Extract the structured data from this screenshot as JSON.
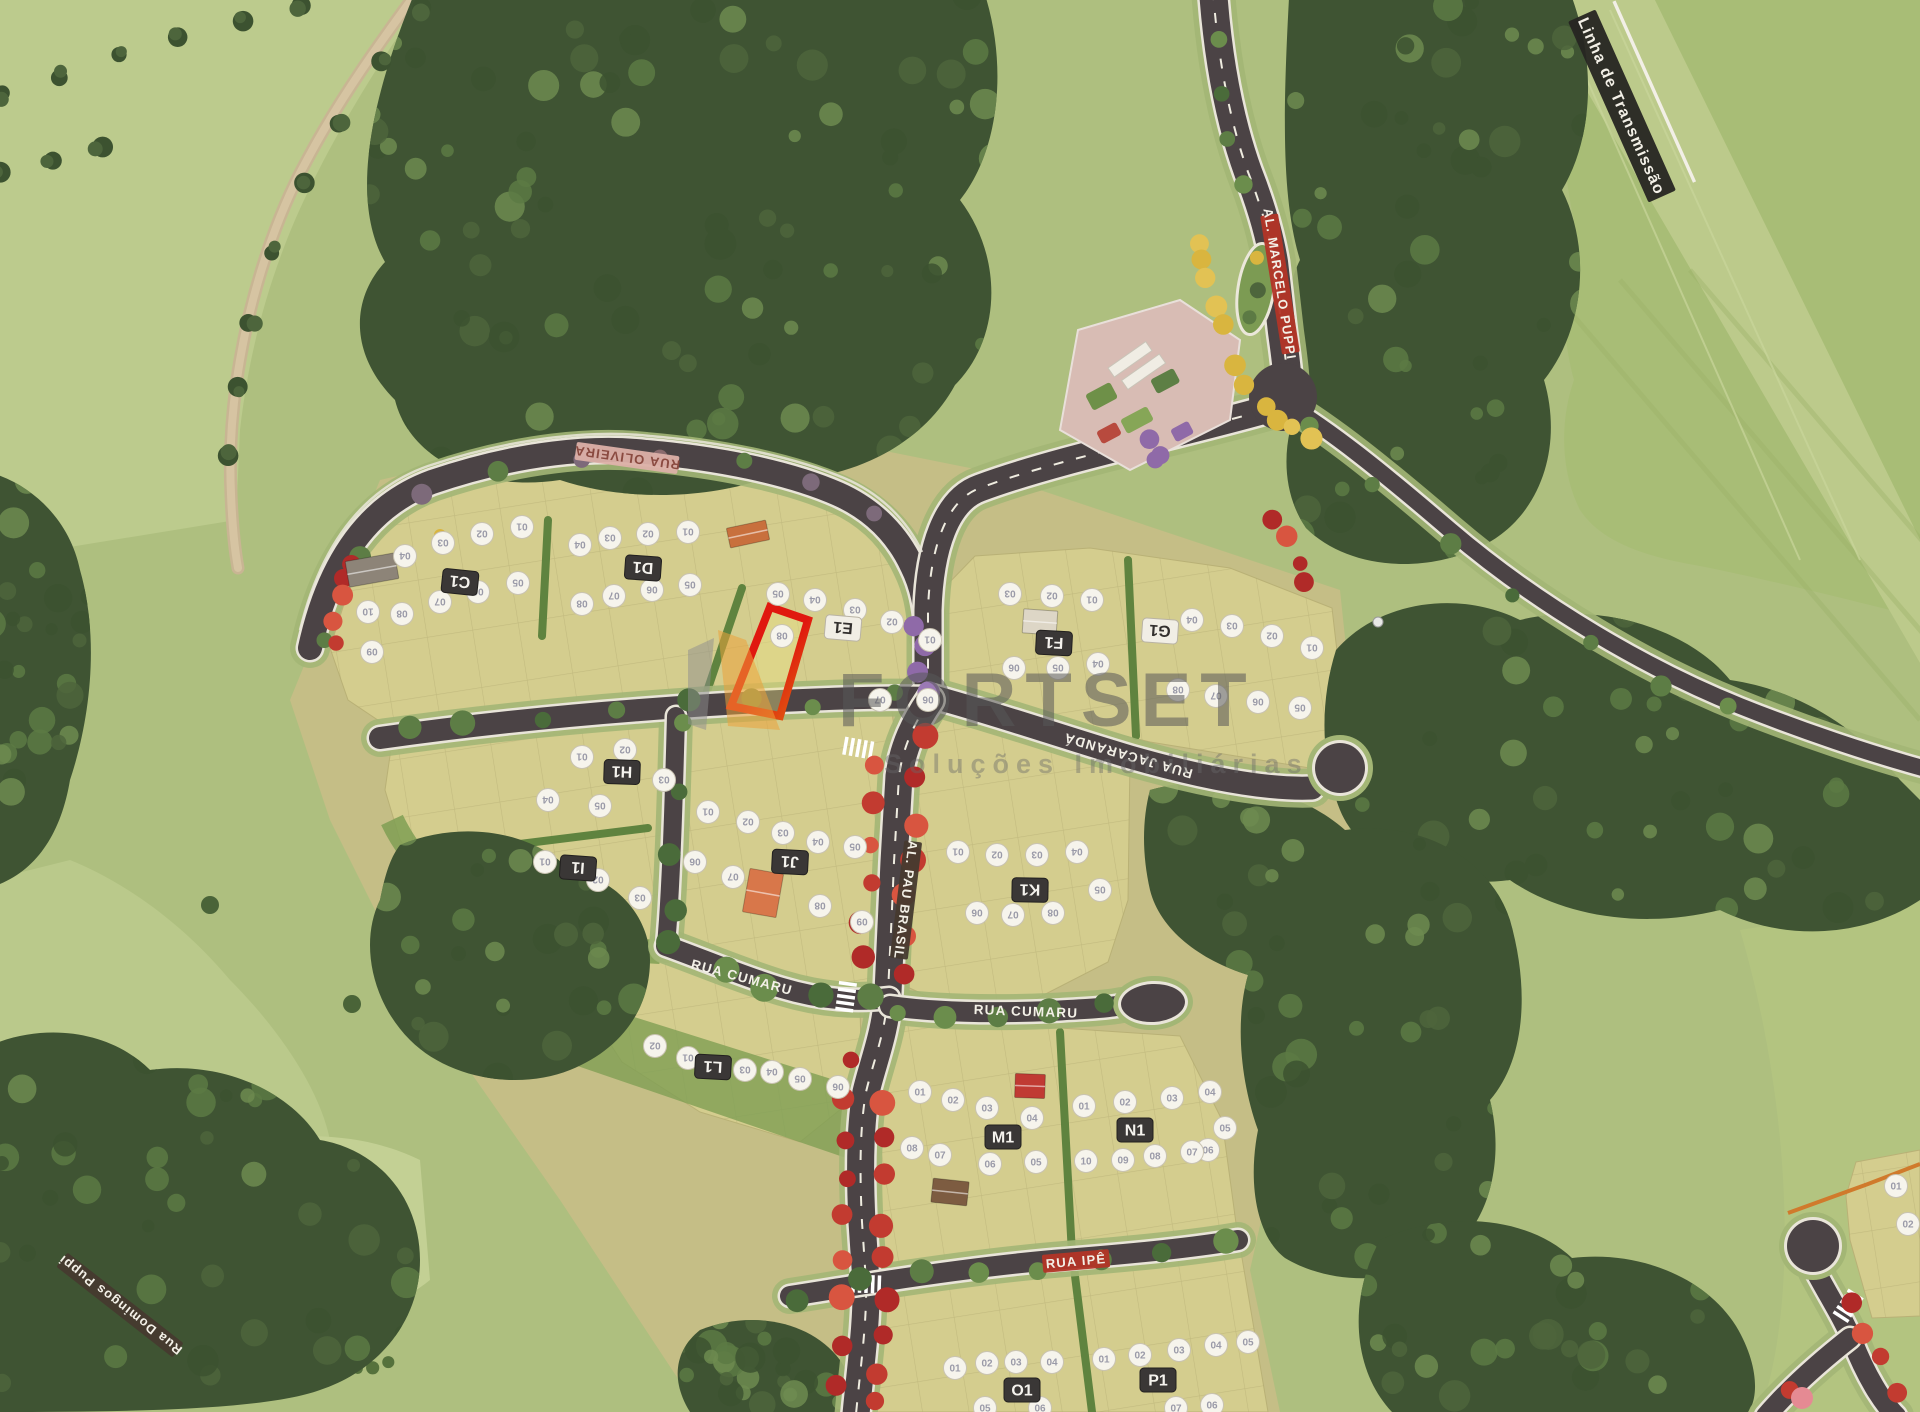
{
  "watermark": {
    "brand": "FORTSET",
    "tagline": "Soluções Imobiliárias"
  },
  "colors": {
    "highlight_outline": "#e0180f",
    "highlight_secondary": "#e06a10",
    "asphalt": "#4b4345",
    "lot_fill": "#d4cd8e",
    "forest": "#3f5433",
    "meadow": "#aebf7f",
    "badge_dark": "#3a3736",
    "badge_light": "#f1eee5",
    "marker_fill": "#f6f4ec",
    "flower_red": "#c23b30",
    "flower_yellow": "#d9b53f",
    "flower_purple": "#8f6aa8",
    "watermark_logo_orange": "#eba33b",
    "watermark_logo_gray": "#8e8e8e"
  },
  "streets": [
    {
      "name": "RUA OLIVEIRA",
      "x": 627,
      "y": 458,
      "rot": 188,
      "style": "pink"
    },
    {
      "name": "RUA JACARANDÁ",
      "x": 1128,
      "y": 756,
      "rot": 196,
      "style": "road"
    },
    {
      "name": "AL. PAU BRASIL",
      "x": 906,
      "y": 900,
      "rot": 97,
      "style": "darkstrip"
    },
    {
      "name": "RUA CUMARU",
      "x": 742,
      "y": 977,
      "rot": 15,
      "style": "road"
    },
    {
      "name": "RUA CUMARU",
      "x": 1026,
      "y": 1011,
      "rot": 2,
      "style": "road"
    },
    {
      "name": "RUA IPÊ",
      "x": 1076,
      "y": 1261,
      "rot": -5,
      "style": "redsign"
    },
    {
      "name": "AL. MARCELO PUPPI",
      "x": 1280,
      "y": 284,
      "rot": 81,
      "style": "redsign"
    },
    {
      "name": "Rua Domingos Puppi",
      "x": 120,
      "y": 1305,
      "rot": 218,
      "style": "darkstrip"
    },
    {
      "name": "Linha de Transmissão",
      "x": 1622,
      "y": 106,
      "rot": 66,
      "style": "blacksign"
    }
  ],
  "blocks": [
    {
      "id": "C1",
      "flipped": true,
      "badge": {
        "x": 460,
        "y": 582,
        "rot": 186,
        "style": "dark"
      },
      "lots": [
        [
          "01",
          522,
          527
        ],
        [
          "02",
          482,
          534
        ],
        [
          "03",
          443,
          543
        ],
        [
          "04",
          405,
          556
        ],
        [
          "05",
          518,
          583
        ],
        [
          "06",
          478,
          592
        ],
        [
          "07",
          440,
          602
        ],
        [
          "08",
          402,
          614
        ],
        [
          "09",
          372,
          652
        ],
        [
          "10",
          368,
          612
        ]
      ]
    },
    {
      "id": "D1",
      "flipped": true,
      "badge": {
        "x": 643,
        "y": 568,
        "rot": 184,
        "style": "dark"
      },
      "lots": [
        [
          "01",
          688,
          532
        ],
        [
          "02",
          648,
          534
        ],
        [
          "03",
          610,
          538
        ],
        [
          "04",
          580,
          545
        ],
        [
          "05",
          690,
          585
        ],
        [
          "06",
          652,
          590
        ],
        [
          "07",
          614,
          596
        ],
        [
          "08",
          582,
          604
        ]
      ]
    },
    {
      "id": "E1",
      "flipped": true,
      "badge": {
        "x": 843,
        "y": 628,
        "rot": 185,
        "style": "light"
      },
      "lots": [
        [
          "01",
          930,
          640
        ],
        [
          "02",
          892,
          622
        ],
        [
          "03",
          855,
          610
        ],
        [
          "04",
          815,
          600
        ],
        [
          "05",
          778,
          594
        ],
        [
          "06",
          928,
          700
        ],
        [
          "07",
          880,
          700
        ],
        [
          "08",
          782,
          636
        ]
      ]
    },
    {
      "id": "F1",
      "flipped": true,
      "badge": {
        "x": 1054,
        "y": 643,
        "rot": 183,
        "style": "dark"
      },
      "lots": [
        [
          "01",
          1092,
          600
        ],
        [
          "02",
          1052,
          596
        ],
        [
          "03",
          1010,
          594
        ],
        [
          "04",
          1098,
          664
        ],
        [
          "05",
          1058,
          668
        ],
        [
          "06",
          1014,
          668
        ]
      ]
    },
    {
      "id": "G1",
      "flipped": true,
      "badge": {
        "x": 1160,
        "y": 631,
        "rot": 184,
        "style": "light"
      },
      "lots": [
        [
          "01",
          1312,
          648
        ],
        [
          "02",
          1272,
          636
        ],
        [
          "03",
          1232,
          626
        ],
        [
          "04",
          1192,
          620
        ],
        [
          "05",
          1300,
          708
        ],
        [
          "06",
          1258,
          702
        ],
        [
          "07",
          1216,
          696
        ],
        [
          "08",
          1178,
          690
        ]
      ]
    },
    {
      "id": "H1",
      "flipped": true,
      "badge": {
        "x": 622,
        "y": 772,
        "rot": 182,
        "style": "dark"
      },
      "lots": [
        [
          "01",
          582,
          757
        ],
        [
          "02",
          625,
          750
        ],
        [
          "03",
          664,
          780
        ],
        [
          "04",
          548,
          800
        ],
        [
          "05",
          600,
          806
        ]
      ]
    },
    {
      "id": "I1",
      "flipped": true,
      "badge": {
        "x": 578,
        "y": 868,
        "rot": 184,
        "style": "dark"
      },
      "lots": [
        [
          "01",
          545,
          862
        ],
        [
          "02",
          598,
          880
        ],
        [
          "03",
          640,
          898
        ]
      ]
    },
    {
      "id": "J1",
      "flipped": true,
      "badge": {
        "x": 790,
        "y": 862,
        "rot": 183,
        "style": "dark"
      },
      "lots": [
        [
          "01",
          708,
          812
        ],
        [
          "02",
          748,
          822
        ],
        [
          "03",
          783,
          833
        ],
        [
          "04",
          818,
          842
        ],
        [
          "05",
          855,
          847
        ],
        [
          "06",
          695,
          862
        ],
        [
          "07",
          733,
          877
        ],
        [
          "08",
          820,
          906
        ],
        [
          "09",
          862,
          922
        ]
      ]
    },
    {
      "id": "K1",
      "flipped": true,
      "badge": {
        "x": 1030,
        "y": 890,
        "rot": 181,
        "style": "dark"
      },
      "lots": [
        [
          "01",
          958,
          852
        ],
        [
          "02",
          997,
          855
        ],
        [
          "03",
          1037,
          855
        ],
        [
          "04",
          1077,
          852
        ],
        [
          "05",
          1100,
          890
        ],
        [
          "06",
          977,
          913
        ],
        [
          "07",
          1013,
          915
        ],
        [
          "08",
          1053,
          913
        ]
      ]
    },
    {
      "id": "L1",
      "flipped": true,
      "badge": {
        "x": 713,
        "y": 1067,
        "rot": 183,
        "style": "dark"
      },
      "lots": [
        [
          "01",
          688,
          1058
        ],
        [
          "02",
          655,
          1046
        ],
        [
          "03",
          745,
          1070
        ],
        [
          "04",
          772,
          1072
        ],
        [
          "05",
          800,
          1079
        ],
        [
          "06",
          838,
          1087
        ]
      ]
    },
    {
      "id": "M1",
      "flipped": false,
      "badge": {
        "x": 1003,
        "y": 1137,
        "rot": 0,
        "style": "dark"
      },
      "lots": [
        [
          "01",
          920,
          1092
        ],
        [
          "02",
          953,
          1100
        ],
        [
          "03",
          987,
          1108
        ],
        [
          "04",
          1032,
          1118
        ],
        [
          "05",
          1036,
          1162
        ],
        [
          "06",
          990,
          1164
        ],
        [
          "07",
          940,
          1155
        ],
        [
          "08",
          912,
          1148
        ]
      ]
    },
    {
      "id": "N1",
      "flipped": false,
      "badge": {
        "x": 1135,
        "y": 1130,
        "rot": 0,
        "style": "dark"
      },
      "lots": [
        [
          "01",
          1084,
          1106
        ],
        [
          "02",
          1125,
          1102
        ],
        [
          "03",
          1172,
          1098
        ],
        [
          "04",
          1210,
          1092
        ],
        [
          "05",
          1225,
          1128
        ],
        [
          "06",
          1208,
          1150
        ],
        [
          "07",
          1192,
          1152
        ],
        [
          "08",
          1155,
          1156
        ],
        [
          "09",
          1123,
          1160
        ],
        [
          "10",
          1086,
          1161
        ]
      ]
    },
    {
      "id": "O1",
      "flipped": false,
      "badge": {
        "x": 1022,
        "y": 1390,
        "rot": 0,
        "style": "dark"
      },
      "lots": [
        [
          "01",
          955,
          1368
        ],
        [
          "02",
          987,
          1363
        ],
        [
          "03",
          1016,
          1362
        ],
        [
          "04",
          1052,
          1362
        ],
        [
          "05",
          985,
          1408
        ],
        [
          "06",
          1040,
          1408
        ]
      ]
    },
    {
      "id": "P1",
      "flipped": false,
      "badge": {
        "x": 1158,
        "y": 1380,
        "rot": 0,
        "style": "dark"
      },
      "lots": [
        [
          "01",
          1104,
          1359
        ],
        [
          "02",
          1140,
          1355
        ],
        [
          "03",
          1179,
          1350
        ],
        [
          "04",
          1216,
          1345
        ],
        [
          "05",
          1248,
          1342
        ],
        [
          "06",
          1212,
          1405
        ],
        [
          "07",
          1176,
          1408
        ]
      ]
    },
    {
      "id": "",
      "flipped": false,
      "badge": null,
      "lots": [
        [
          "01",
          1896,
          1186
        ],
        [
          "02",
          1908,
          1224
        ]
      ]
    }
  ]
}
